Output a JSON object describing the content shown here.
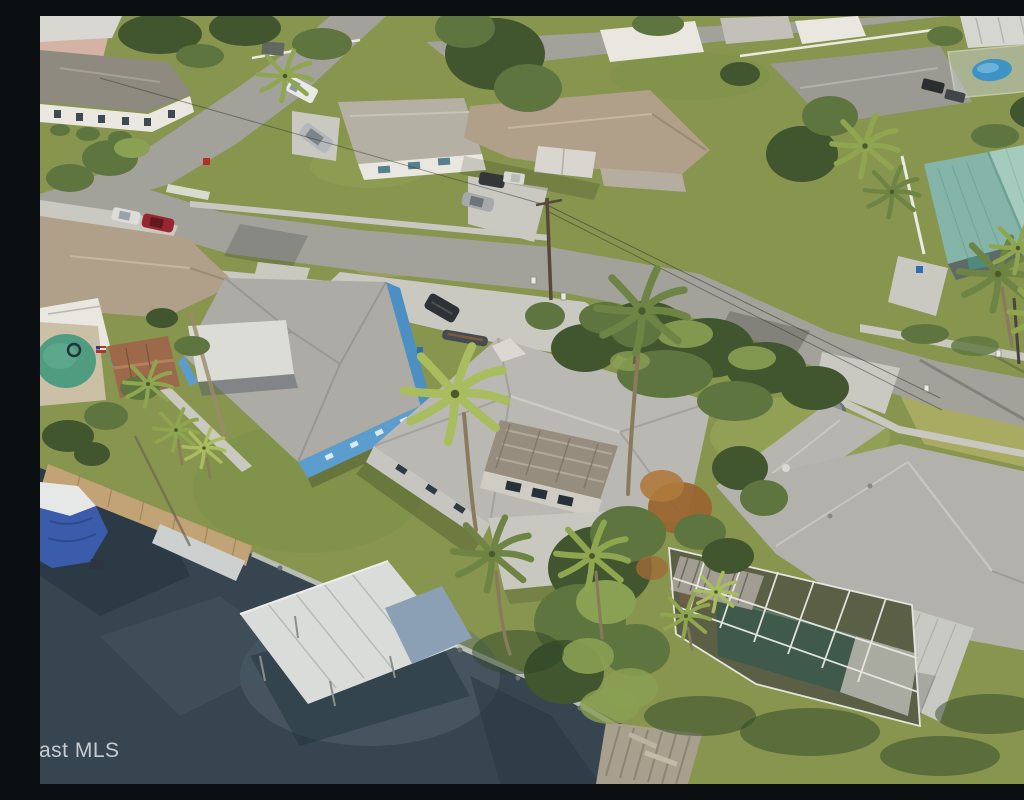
{
  "meta": {
    "type": "aerial-photograph",
    "description": "Aerial drone view of a waterfront residential neighborhood: single-family homes along curving streets, a dark canal with wooden docks, a covered boat lift, a blue tarp-covered boat, a screened swimming-pool enclosure, palm trees and green lawns.",
    "watermark": {
      "text": "ast MLS"
    }
  },
  "colors": {
    "grass": "#87954f",
    "grassBright": "#b2b068",
    "water": "#36454f",
    "waterLight": "#5d6d77",
    "road": "#a2a29b",
    "walk": "#c8c8c0",
    "conc": "#cac9c1",
    "roofGray": "#b6b5af",
    "roofLight": "#d8d7d2",
    "roofDark": "#93928c",
    "roofTan": "#b0a089",
    "roofTeal": "#8fbcae",
    "houseBlue": "#5b9dce",
    "wallWhite": "#e9e7df",
    "treeDark": "#41552f",
    "treeMid": "#5e7540",
    "treeLight": "#8aa052",
    "palmGreen": "#8fa54f",
    "dockWood": "#c2a376",
    "boatBlue": "#3a5cab",
    "poolGreen": "#4f9c80",
    "poolBlue": "#3e93c4",
    "watermark": "#d4d9dd"
  },
  "scene": {
    "features": [
      "canal-water",
      "seawall",
      "wooden-dock",
      "boat-ramp",
      "covered-boat-lift",
      "tarp-covered-boat",
      "old-wooden-dock",
      "blue-house",
      "center-house",
      "right-house",
      "pool-screen-enclosure",
      "teal-roof-house",
      "backyard-pool",
      "hot-tub-shed",
      "main-street",
      "side-street",
      "top-street",
      "driveways",
      "parked-cars",
      "palm-trees",
      "utility-pole",
      "mls-watermark"
    ]
  }
}
